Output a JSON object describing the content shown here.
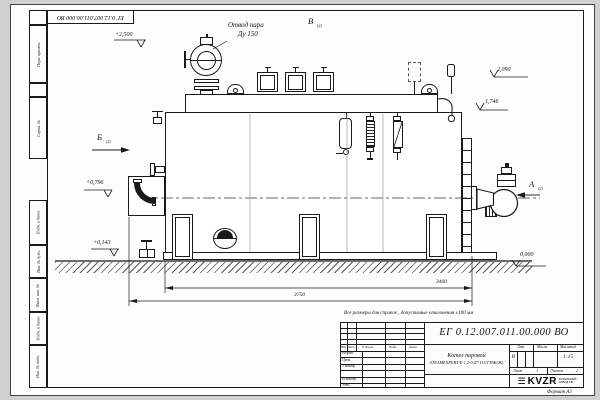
{
  "doc_number": "ЕГ 0.12.007.011.00.000 ВО",
  "note": "Все размеры для справок , допустимые отклонения ±100 мм",
  "format_label": "Формат А3",
  "margin_labels": [
    "Перв. примен.",
    "Справ. №",
    "Подп. и дата",
    "Инв. № дубл.",
    "Взам. инв. №",
    "Подп. и дата",
    "Инв. № подл."
  ],
  "callout": {
    "line1": "Отвод пара",
    "line2": "Ду 150"
  },
  "views": {
    "left": "Б",
    "top": "В",
    "right": "А",
    "sheet_ref": "(2)"
  },
  "elevations": [
    "+2,500",
    "2,090",
    "1,746",
    "+0,796",
    "+0,143",
    "0,000"
  ],
  "dimensions": [
    "3400",
    "3750"
  ],
  "title_block": {
    "product_name": "Котел паровой",
    "product_model": "STEAMEXPERT-Е-1,2-0,07-115-ГПЖ(Ж)",
    "columns": {
      "izm": "Изм",
      "list": "Лист",
      "doc": "N докум.",
      "podp": "Подп.",
      "date": "Дата"
    },
    "roles": {
      "r1": "Разраб.",
      "r2": "Пров.",
      "r3": "Т.контр.",
      "r4": "Н.контр.",
      "r5": "Утв."
    },
    "lit_label": "Лит.",
    "lit_value": "И",
    "mass_label": "Масса",
    "scale_label": "Масштаб",
    "scale_value": "1:15",
    "sheet_label": "Лист",
    "sheet_value": "1",
    "sheets_label": "Листов",
    "sheets_value": "2",
    "logo_text": "KVZR",
    "logo_sub1": "КОТЕЛЬНЫЙ",
    "logo_sub2": "ЗАВОД РФ"
  }
}
